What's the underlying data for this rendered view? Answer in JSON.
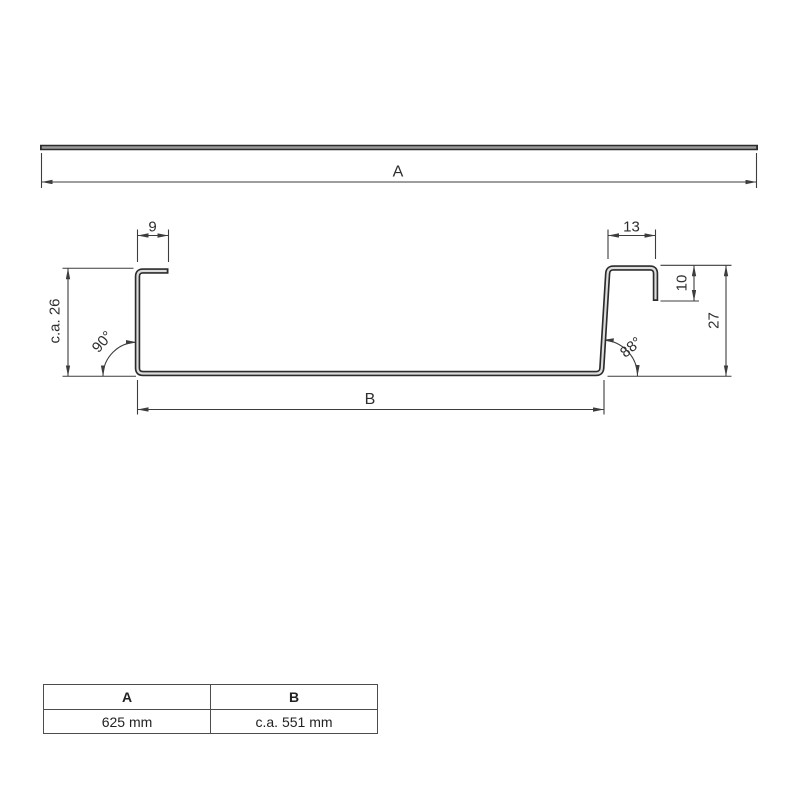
{
  "colors": {
    "line": "#3d3d3d",
    "text": "#2e2e2e",
    "sheet_outline": "#2b2b2b",
    "sheet_inner": "#dcdcdc",
    "bar_inner": "#9b9b9b"
  },
  "top_view": {
    "dim_overall_width": "A"
  },
  "section_view": {
    "dim_left_flange": "9",
    "dim_right_flange": "13",
    "dim_right_lip": "10",
    "dim_right_height": "27",
    "dim_left_height": "c.a. 26",
    "dim_bottom_width": "B",
    "angle_left": "90°",
    "angle_right": "88°"
  },
  "dimension_table": {
    "headers": [
      "A",
      "B"
    ],
    "values": [
      "625 mm",
      "c.a. 551 mm"
    ]
  }
}
